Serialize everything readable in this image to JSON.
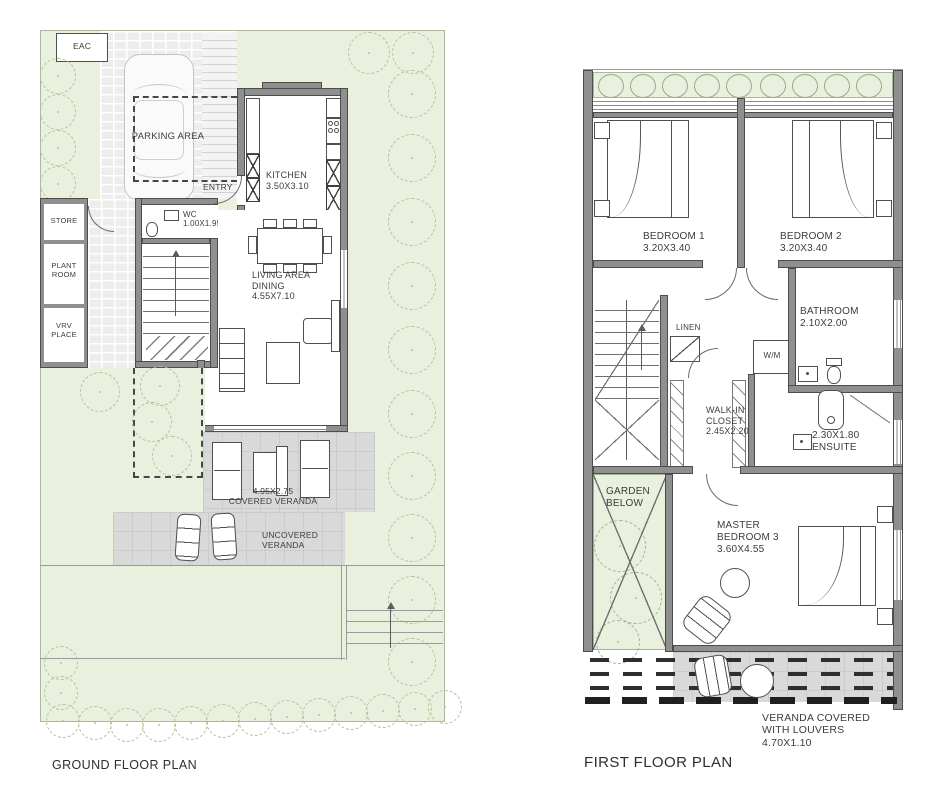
{
  "ground_floor": {
    "title": "GROUND FLOOR PLAN",
    "labels": {
      "eac": "EAC",
      "parking_area": "PARKING AREA",
      "entry": "ENTRY",
      "kitchen_name": "KITCHEN",
      "kitchen_dims": "3.50X3.10",
      "wc_name": "WC",
      "wc_dims": "1.00X1.95",
      "store": "STORE",
      "plant_room": "PLANT ROOM",
      "vrv_place": "VRV PLACE",
      "living_line1": "LIVING AREA",
      "living_line2": "DINING",
      "living_dims": "4.55X7.10",
      "covered_veranda_dims": "4.95X2.75",
      "covered_veranda": "COVERED VERANDA",
      "uncovered_veranda": "UNCOVERED VERANDA"
    }
  },
  "first_floor": {
    "title": "FIRST FLOOR PLAN",
    "labels": {
      "bedroom1_name": "BEDROOM 1",
      "bedroom1_dims": "3.20X3.40",
      "bedroom2_name": "BEDROOM 2",
      "bedroom2_dims": "3.20X3.40",
      "bathroom_name": "BATHROOM",
      "bathroom_dims": "2.10X2.00",
      "linen": "LINEN",
      "wm": "W/M",
      "walkin_name": "WALK-IN CLOSET",
      "walkin_dims": "2.45X2.20",
      "ensuite_dims": "2.30X1.80",
      "ensuite_name": "ENSUITE",
      "garden_below": "GARDEN BELOW",
      "master_name": "MASTER BEDROOM 3",
      "master_dims": "3.60X4.55",
      "veranda_name": "VERANDA COVERED WITH LOUVERS",
      "veranda_dims": "4.70X1.10"
    }
  },
  "colors": {
    "site_green": "#e9f1de",
    "tile_gray": "#d9d9d9",
    "wall_gray": "#8f8f8f",
    "ink": "#3c3c3c",
    "tree_stroke": "#aec69a"
  }
}
